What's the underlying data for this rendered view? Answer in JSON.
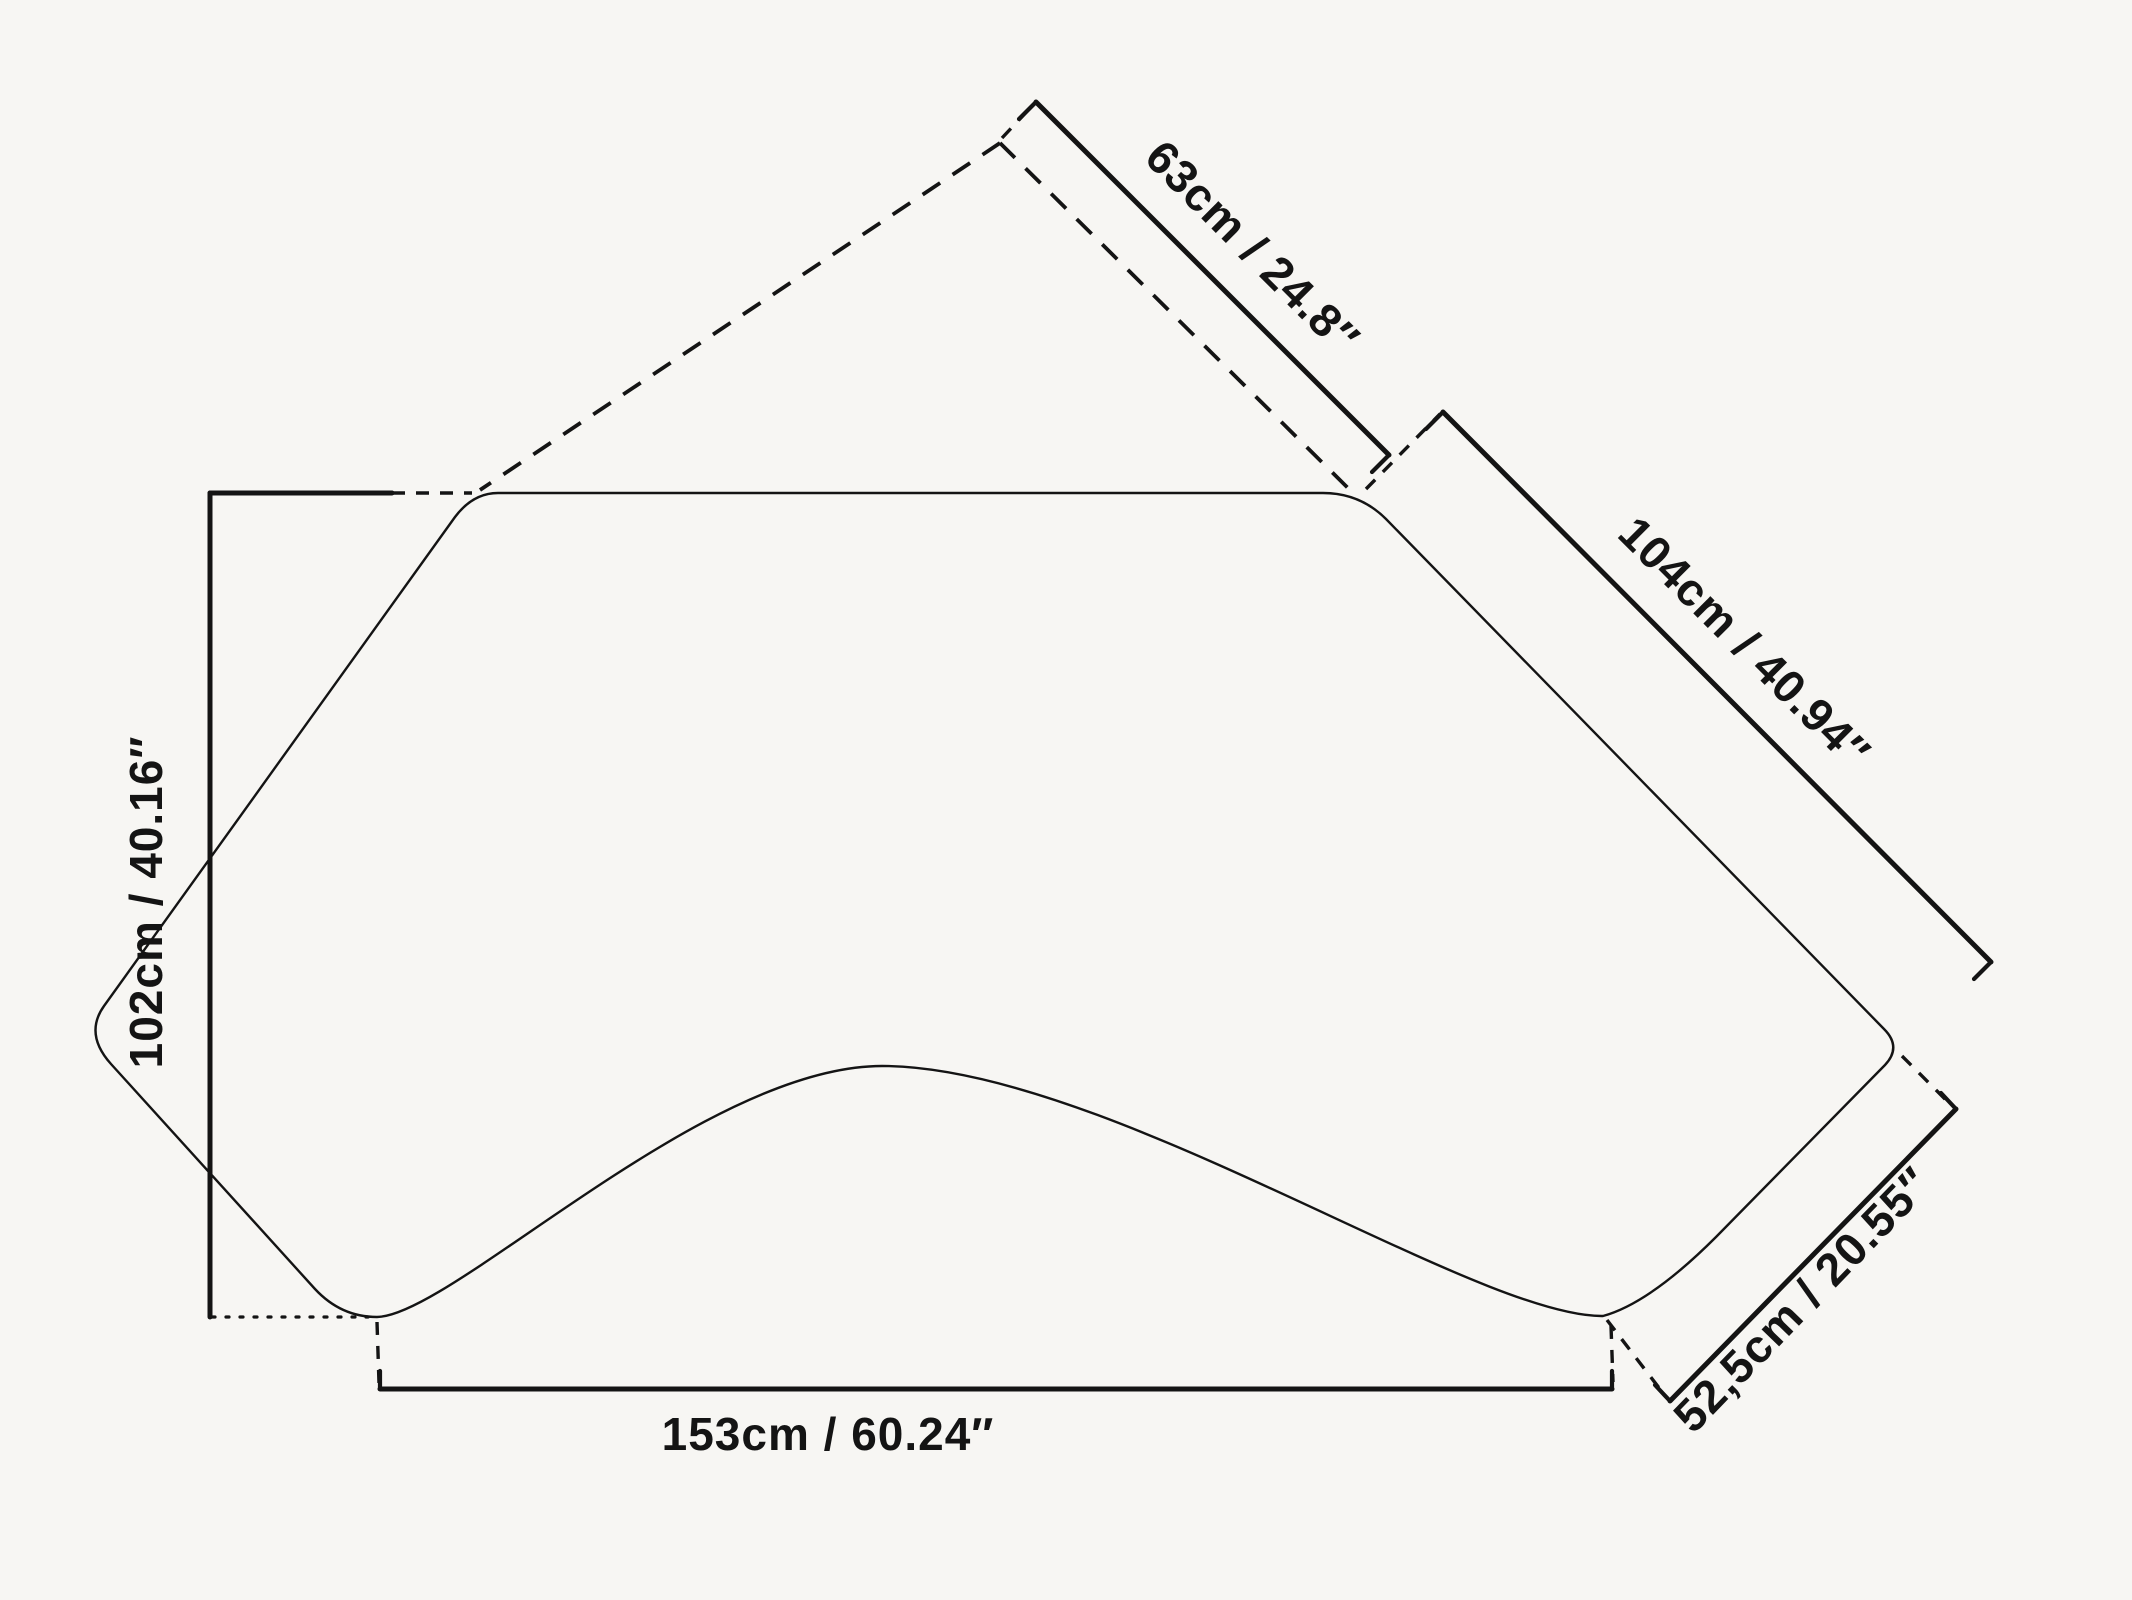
{
  "drawing": {
    "background_color": "#f7f6f3",
    "stroke_color": "#141414",
    "labels": {
      "back_top": "63cm / 24.8″",
      "side_right": "104cm / 40.94″",
      "height_left": "102cm / 40.16″",
      "width_bottom": "153cm / 60.24″",
      "edge_bottom_right": "52,5cm / 20.55″"
    }
  }
}
